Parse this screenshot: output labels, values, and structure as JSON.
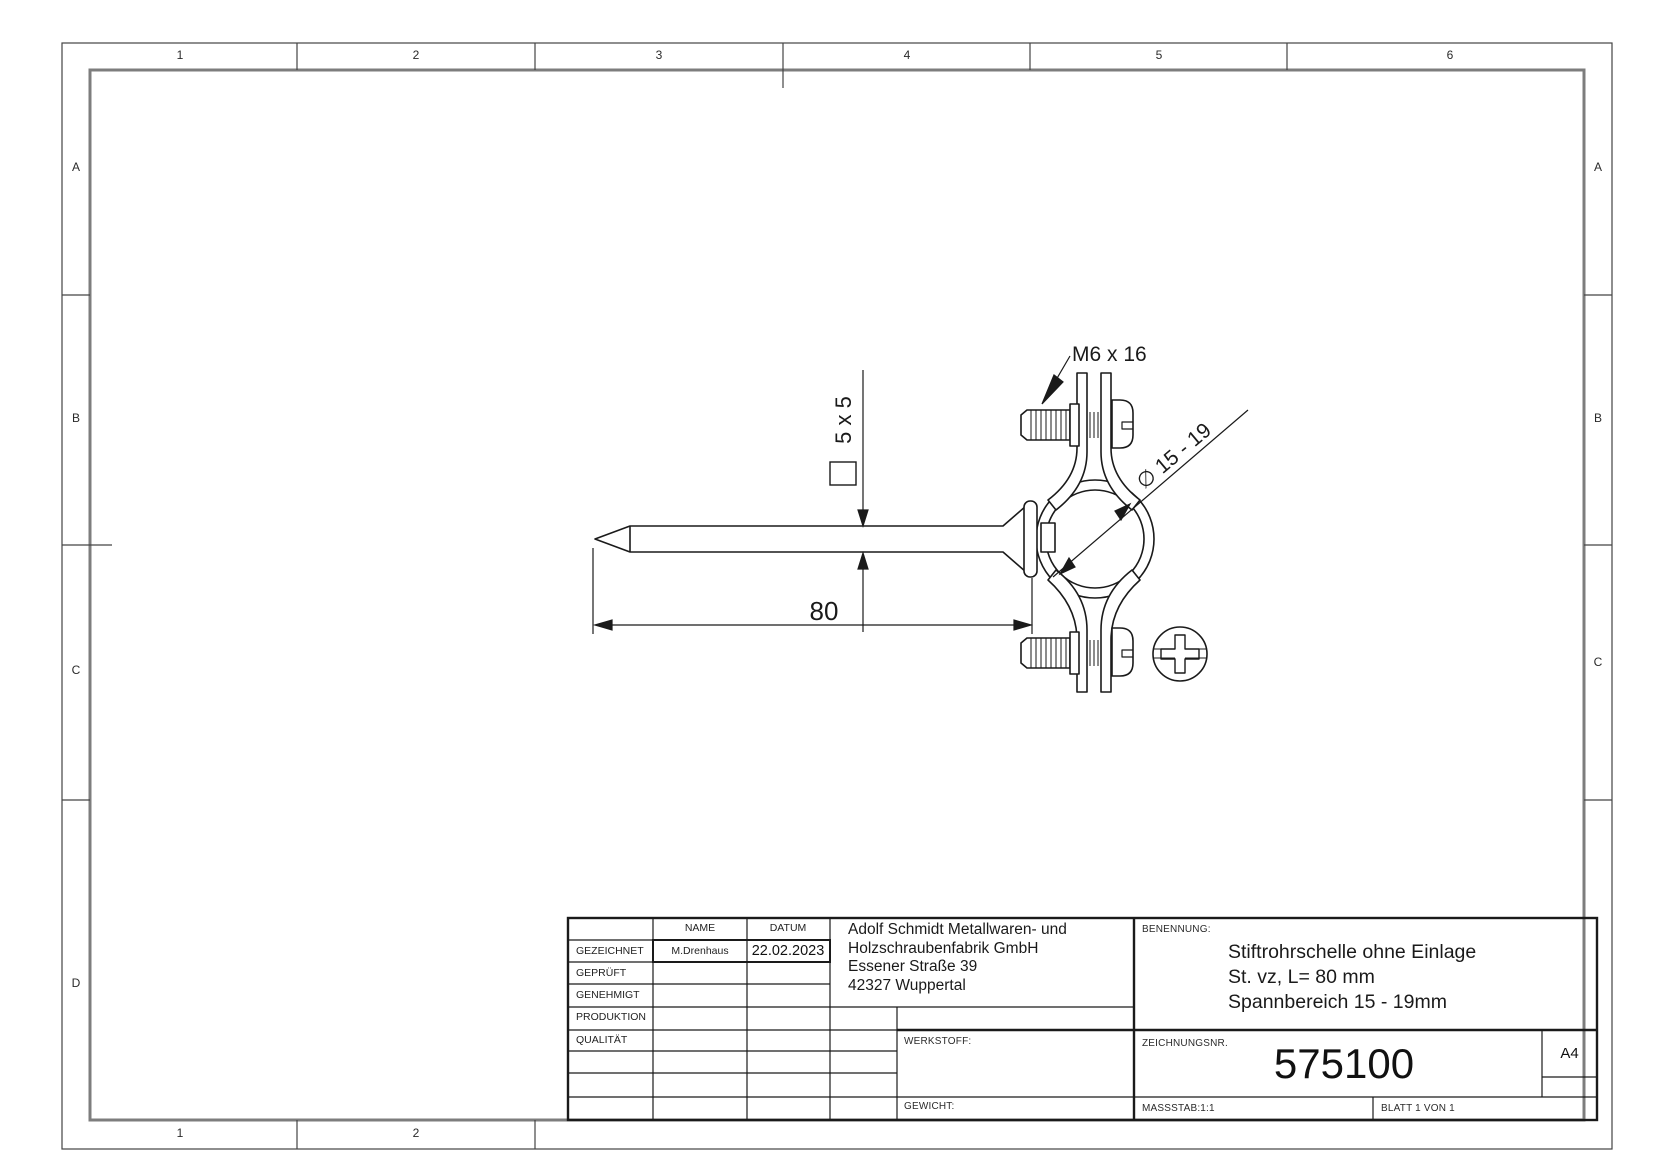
{
  "drawing": {
    "grid": {
      "cols": [
        "1",
        "2",
        "3",
        "4",
        "5",
        "6"
      ],
      "rows": [
        "A",
        "B",
        "C",
        "D"
      ]
    },
    "annotations": {
      "screw": "M6 x 16",
      "square_section": "5 x 5",
      "length": "80",
      "clamp_range": "∅ 15 - 19"
    }
  },
  "title_block": {
    "approvals": {
      "name_header": "NAME",
      "date_header": "DATUM",
      "rows": [
        {
          "label": "GEZEICHNET",
          "name": "M.Drenhaus",
          "date": "22.02.2023"
        },
        {
          "label": "GEPRÜFT",
          "name": "",
          "date": ""
        },
        {
          "label": "GENEHMIGT",
          "name": "",
          "date": ""
        },
        {
          "label": "PRODUKTION",
          "name": "",
          "date": ""
        },
        {
          "label": "QUALITÄT",
          "name": "",
          "date": ""
        }
      ]
    },
    "company": {
      "line1": "Adolf Schmidt Metallwaren- und",
      "line2": "Holzschraubenfabrik GmbH",
      "line3": "Essener Straße 39",
      "line4": "42327 Wuppertal"
    },
    "benennung": {
      "label": "BENENNUNG:",
      "line1": "Stiftrohrschelle ohne Einlage",
      "line2": "St. vz, L= 80 mm",
      "line3": "Spannbereich 15 - 19mm"
    },
    "werkstoff_label": "WERKSTOFF:",
    "gewicht_label": "GEWICHT:",
    "zeichnungsnr": {
      "label": "ZEICHNUNGSNR.",
      "value": "575100"
    },
    "format": "A4",
    "massstab": "MASSSTAB:1:1",
    "blatt": "BLATT 1 VON 1"
  }
}
